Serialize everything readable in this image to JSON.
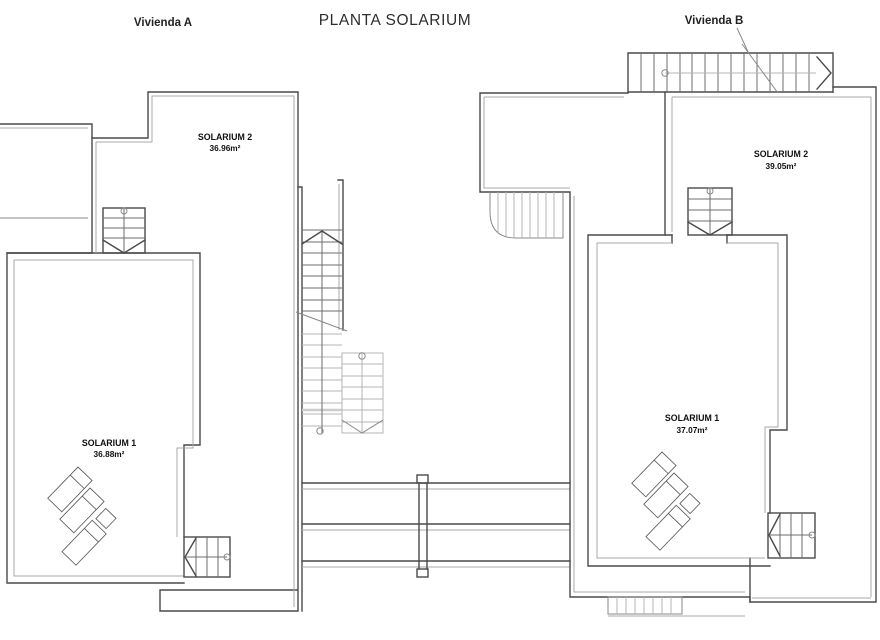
{
  "page": {
    "title": "PLANTA SOLARIUM"
  },
  "units": {
    "a": {
      "name": "Vivienda A",
      "solarium2": {
        "label": "SOLARIUM 2",
        "area": "36.96m²"
      },
      "solarium1": {
        "label": "SOLARIUM 1",
        "area": "36.88m²"
      }
    },
    "b": {
      "name": "Vivienda B",
      "solarium2": {
        "label": "SOLARIUM 2",
        "area": "39.05m²"
      },
      "solarium1": {
        "label": "SOLARIUM 1",
        "area": "37.07m²"
      }
    }
  },
  "colors": {
    "background": "#ffffff",
    "wall": "#4a4a4a",
    "wall_inner": "#a9a9a9",
    "text": "#101010"
  }
}
